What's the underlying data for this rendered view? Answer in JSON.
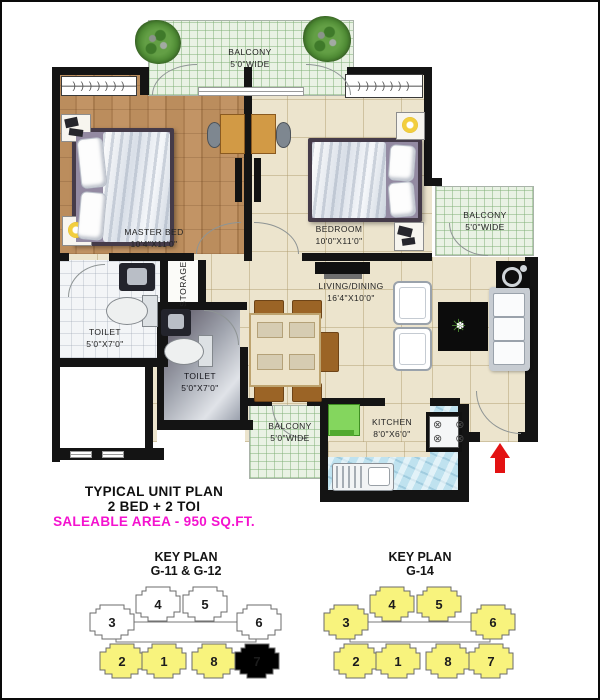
{
  "plan": {
    "rooms": {
      "balcony_top": {
        "name": "BALCONY",
        "dim": "5'0\"WIDE"
      },
      "balcony_right": {
        "name": "BALCONY",
        "dim": "5'0\"WIDE"
      },
      "balcony_bottom": {
        "name": "BALCONY",
        "dim": "5'0\"WIDE"
      },
      "master_bed": {
        "name": "MASTER BED",
        "dim": "10'4\"X11'0\""
      },
      "bedroom": {
        "name": "BEDROOM",
        "dim": "10'0\"X11'0\""
      },
      "living_dining": {
        "name": "LIVING/DINING",
        "dim": "16'4\"X10'0\""
      },
      "kitchen": {
        "name": "KITCHEN",
        "dim": "8'0\"X6'0\""
      },
      "toilet_1": {
        "name": "TOILET",
        "dim": "5'0\"X7'0\""
      },
      "toilet_2": {
        "name": "TOILET",
        "dim": "5'0\"X7'0\""
      },
      "storage": {
        "name": "STORAGE"
      }
    },
    "icons": {
      "hanger_row": ") ) ) ) ) ) )",
      "burners_row": "⊗ ⊗",
      "plant_outer": "✳",
      "plant_inner": "✽"
    },
    "colors": {
      "entry_arrow": "#e31212",
      "fridge_green": "#84d65e",
      "highlight_yellow": "#f8f37d",
      "accent_magenta": "#f412cf"
    }
  },
  "caption": {
    "line1": "TYPICAL UNIT PLAN",
    "line2": "2 BED + 2 TOI",
    "line3": "SALEABLE AREA - 950 SQ.FT."
  },
  "key_plans": [
    {
      "title1": "KEY PLAN",
      "title2": "G-11 & G-12",
      "units": [
        {
          "label": "4",
          "fill": "#ffffff"
        },
        {
          "label": "5",
          "fill": "#ffffff"
        },
        {
          "label": "3",
          "fill": "#ffffff"
        },
        {
          "label": "6",
          "fill": "#ffffff"
        },
        {
          "label": "2",
          "fill": "#f8f37d"
        },
        {
          "label": "1",
          "fill": "#f8f37d"
        },
        {
          "label": "8",
          "fill": "#f8f37d"
        },
        {
          "label": "7",
          "fill": "#f8f37d"
        }
      ]
    },
    {
      "title1": "KEY PLAN",
      "title2": "G-14",
      "units": [
        {
          "label": "4",
          "fill": "#f8f37d"
        },
        {
          "label": "5",
          "fill": "#f8f37d"
        },
        {
          "label": "3",
          "fill": "#f8f37d"
        },
        {
          "label": "6",
          "fill": "#f8f37d"
        },
        {
          "label": "2",
          "fill": "#f8f37d"
        },
        {
          "label": "1",
          "fill": "#f8f37d"
        },
        {
          "label": "8",
          "fill": "#f8f37d"
        },
        {
          "label": "7",
          "fill": "#f8f37d"
        }
      ]
    }
  ]
}
